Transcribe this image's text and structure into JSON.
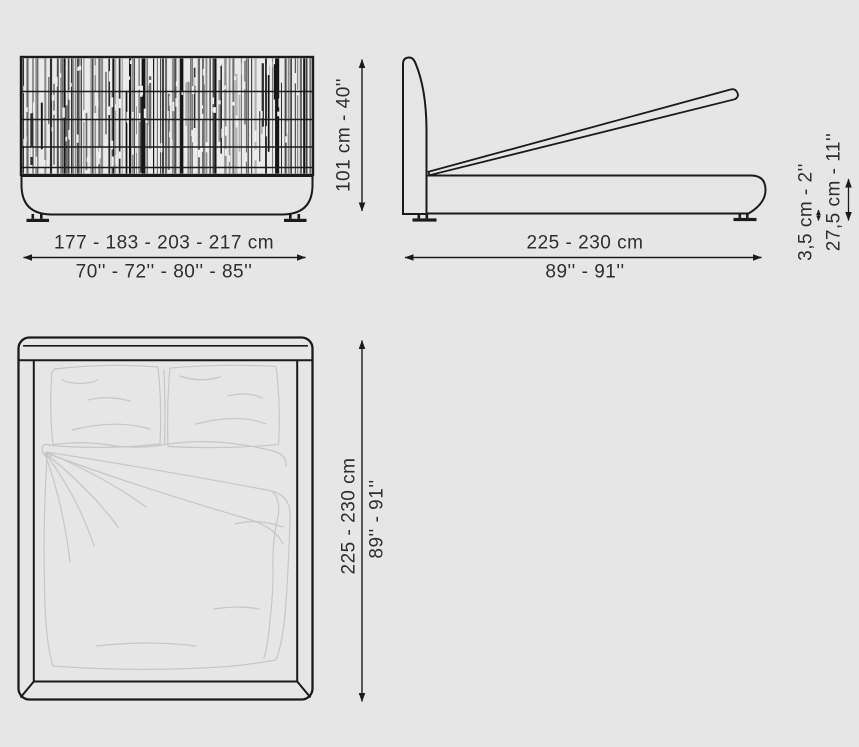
{
  "colors": {
    "bg": "#e6e6e6",
    "line": "#1b1b1b",
    "sketch": "#c7c7c7",
    "text": "#2e2e2e",
    "fill": "#eaeaea"
  },
  "front_view": {
    "width_cm": "177 - 183 - 203 - 217 cm",
    "width_inches": "70'' - 72'' - 80'' - 85''",
    "height": "101 cm - 40''"
  },
  "side_view": {
    "length_cm": "225 - 230 cm",
    "length_inches": "89'' - 91''",
    "feet_height": "3,5 cm - 2''",
    "storage_height": "27,5 cm - 11''"
  },
  "top_view": {
    "length_cm": "225 - 230 cm",
    "length_inches": "89'' - 91''"
  }
}
